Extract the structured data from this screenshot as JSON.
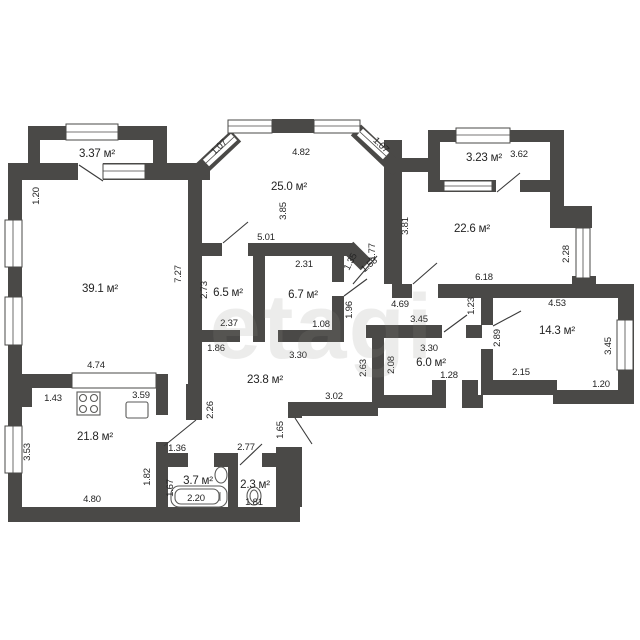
{
  "watermark": "etagi",
  "rooms": {
    "living": "39.1 м²",
    "kitchen": "21.8 м²",
    "hallway": "23.8 м²",
    "room1": "25.0 м²",
    "room2": "22.6 м²",
    "room3": "14.3 м²",
    "walkin1": "6.5 м²",
    "walkin2": "6.7 м²",
    "entry": "6.0 м²",
    "bathroom": "3.7 м²",
    "wc": "2.3 м²",
    "balcony_left": "3.37 м²",
    "balcony_right": "3.23 м²"
  },
  "dims": {
    "left_top": "1.20",
    "bay_left": "1.07",
    "bay_top": "4.82",
    "bay_right": "1.07",
    "room1_depth": "3.85",
    "balcony_right_len": "3.62",
    "room1_bottom": "5.01",
    "walkin2_top": "2.31",
    "chamfer": "1.35",
    "chamfer_door": "1.58",
    "wall_177": "1.77",
    "room2_left": "3.81",
    "living_right": "7.27",
    "walkin1_left": "2.73",
    "walkin1_bottom": "2.37",
    "walkin1_under": "1.86",
    "walkin2_bottom": "1.08",
    "nook_width": "1.96",
    "room2_bottom": "6.18",
    "room2_right": "2.28",
    "corridor_len": "4.69",
    "wall_123": "1.23",
    "hall_top": "3.30",
    "hall_right": "2.63",
    "hall_bottom": "3.02",
    "entry_top": "3.45",
    "entry_width": "3.30",
    "entry_left": "2.08",
    "entry_door": "1.28",
    "room3_top": "4.53",
    "room3_bottom": "2.15",
    "room3_right": "3.45",
    "room3_step": "1.20",
    "room3_left": "2.89",
    "living_bottom": "4.74",
    "kitchen_top": "1.43",
    "kitchen_sink": "3.59",
    "kitchen_left": "3.53",
    "kitchen_bottom": "4.80",
    "lobby_wall": "2.26",
    "kitchen_door": "1.36",
    "bath_outer": "1.82",
    "bath_inner": "1.67",
    "bathtub": "2.20",
    "wc_top": "2.77",
    "wc_inner": "1.81",
    "exit_door": "1.65"
  }
}
